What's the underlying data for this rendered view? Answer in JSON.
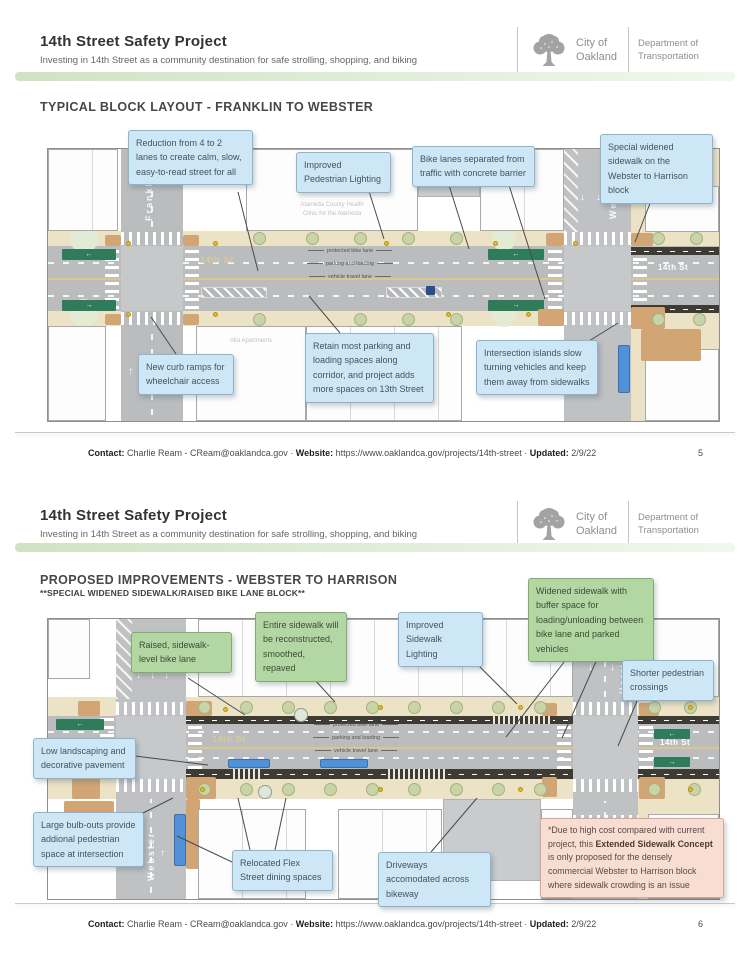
{
  "glyphs": {
    "arrow_left": "←",
    "arrow_right": "→",
    "arrow_up": "↑",
    "arrow_down": "↓"
  },
  "header": {
    "title": "14th Street Safety Project",
    "subtitle": "Investing in 14th Street as a community destination for safe strolling, shopping, and biking",
    "city_line1": "City of",
    "city_line2": "Oakland",
    "dept_line1": "Department of",
    "dept_line2": "Transportation"
  },
  "footer": {
    "contact_label": "Contact:",
    "contact_value": "Charlie Ream - CReam@oaklandca.gov",
    "sep": "·",
    "website_label": "Website:",
    "website_value": "https://www.oaklandca.gov/projects/14th-street",
    "updated_label": "Updated:",
    "updated_value": "2/9/22"
  },
  "page1": {
    "page_number": "5",
    "section_title": "TYPICAL BLOCK LAYOUT - FRANKLIN TO WEBSTER",
    "callouts": {
      "reduction": "Reduction from 4 to 2 lanes to create calm, slow, easy-to-read street for all",
      "ped_lighting": "Improved Pedestrian Lighting",
      "bike_lanes": "Bike lanes separated from traffic with concrete barrier",
      "widened_sidewalk": "Special widened sidewalk on the Webster to Harrison block",
      "curb_ramps": "New curb ramps for wheelchair access",
      "parking": "Retain most parking and loading spaces along corridor, and project adds more spaces on 13th Street",
      "islands": "Intersection islands slow turning vehicles and keep them away from sidewalks"
    },
    "map": {
      "franklin": "Franklin",
      "webster": "Webster",
      "st_mid": "14th St",
      "st_right": "14th St",
      "lane_bike": "protected bike lane",
      "lane_parking": "parking and loading",
      "lane_travel": "vehicle travel lane",
      "clinic_line1": "Alameda County Health",
      "clinic_line2": "Clinic for the Alameda",
      "apartments": "Alta Apartments"
    }
  },
  "page2": {
    "page_number": "6",
    "section_title": "PROPOSED IMPROVEMENTS - WEBSTER TO HARRISON",
    "section_subtitle": "**SPECIAL WIDENED SIDEWALK/RAISED BIKE LANE BLOCK**",
    "callouts": {
      "raised_lane": "Raised, sidewalk-level bike lane",
      "sidewalk_rebuilt": "Entire sidewalk will be reconstructed, smoothed, repaved",
      "widened_buffer": "Widened sidewalk with buffer space for loading/unloading between bike lane and parked vehicles",
      "sidewalk_lighting": "Improved Sidewalk Lighting",
      "shorter_crossings": "Shorter pedestrian crossings",
      "landscaping": "Low landscaping and decorative pavement",
      "bulb_outs": "Large bulb-outs provide addional pedestrian space at intersection",
      "flex_street": "Relocated Flex Street dining spaces",
      "driveways": "Driveways accomodated across bikeway"
    },
    "note": {
      "prefix": "*Due to high cost compared with current project, this ",
      "bold": "Extended Sidewalk Concept",
      "suffix": " is only proposed for the densely commercial Webster to Harrison block where sidewalk crowding is an issue"
    },
    "map": {
      "webster": "Webster",
      "harrison": "Harrison",
      "st_mid": "14th St",
      "st_right": "14th St",
      "lane_bike": "protected bike lane",
      "lane_parking": "parking and loading",
      "lane_travel": "vehicle travel lane"
    }
  }
}
